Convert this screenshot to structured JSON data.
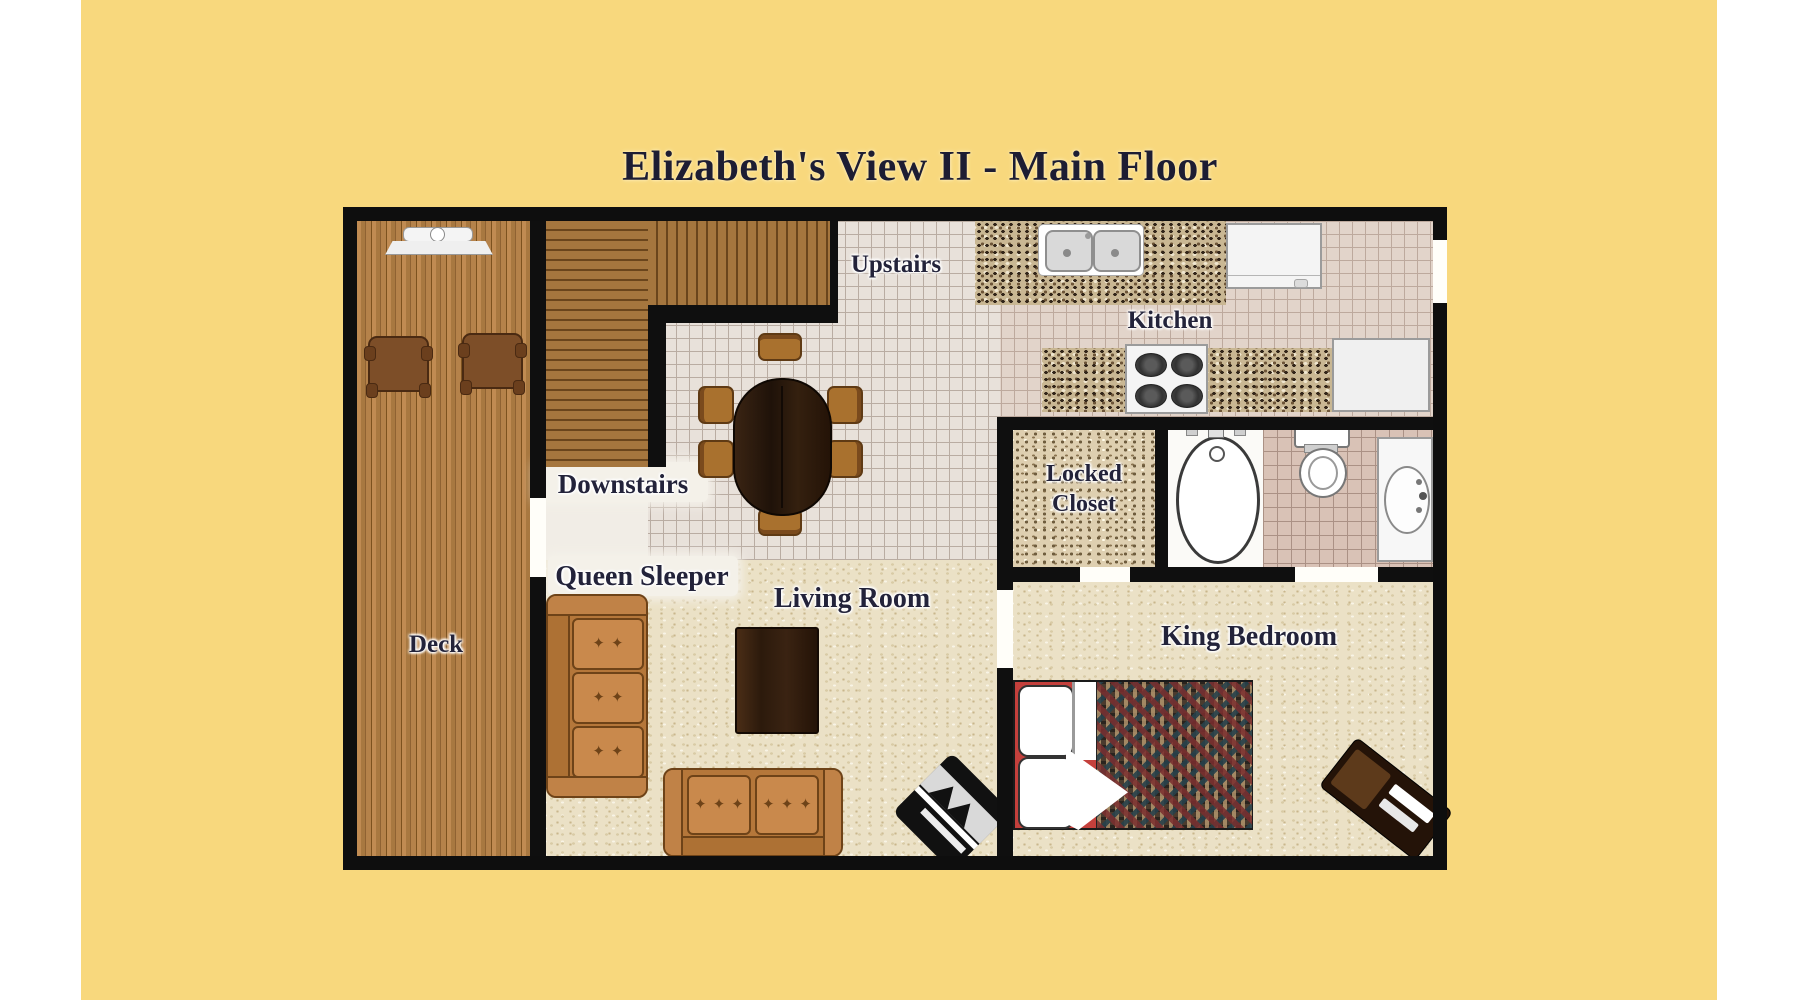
{
  "title": "Elizabeth's View II - Main Floor",
  "rooms": {
    "deck": "Deck",
    "upstairs": "Upstairs",
    "downstairs": "Downstairs",
    "kitchen": "Kitchen",
    "locked_closet_line1": "Locked",
    "locked_closet_line2": "Closet",
    "queen_sleeper": "Queen Sleeper",
    "living_room": "Living Room",
    "king_bedroom": "King Bedroom"
  },
  "icons": {
    "tufting_mark": "✦",
    "furniture": [
      "grill-icon",
      "deck-chair-icon",
      "staircase-icon",
      "dining-table-icon",
      "dining-chair-icon",
      "kitchen-sink-icon",
      "refrigerator-icon",
      "stove-icon",
      "dishwasher-icon",
      "bathtub-icon",
      "toilet-icon",
      "vanity-sink-icon",
      "sleeper-sofa-icon",
      "loveseat-icon",
      "coffee-table-icon",
      "corner-fireplace-icon",
      "king-bed-icon",
      "desk-icon"
    ]
  },
  "colors": {
    "background_yellow": "#f8d87d",
    "page_margin_white": "#ffffff",
    "wall_black": "#0f0f0f",
    "label_text": "#23233a",
    "carpet": "#ebe1c6",
    "tile": "#e8e1da",
    "bathroom_tile": "#d9c2b6",
    "deck_wood": "#b07c44",
    "stair_wood": "#9a6c36",
    "sofa_orange": "#c08040",
    "dark_table_wood": "#2f1d10",
    "bed_red": "#c4403c"
  }
}
